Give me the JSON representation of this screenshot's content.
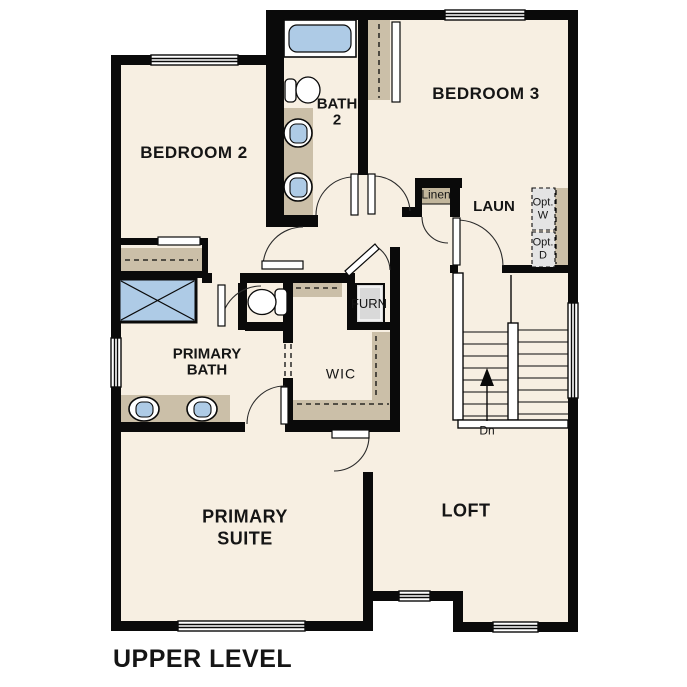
{
  "title": "UPPER LEVEL",
  "rooms": {
    "bedroom2": "BEDROOM 2",
    "bedroom3": "BEDROOM 3",
    "bath2": [
      "BATH",
      "2"
    ],
    "laundry": "LAUN",
    "loft": "LOFT",
    "primary_bath": [
      "PRIMARY",
      "BATH"
    ],
    "primary_suite": [
      "PRIMARY",
      "SUITE"
    ],
    "wic": "WIC"
  },
  "closets": {
    "linen": "Linen",
    "furnace": "FURN"
  },
  "appliances": {
    "optional_washer": [
      "Opt.",
      "W"
    ],
    "optional_dryer": [
      "Opt.",
      "D"
    ]
  },
  "stairs": {
    "direction_label": "Dn"
  },
  "colors": {
    "floor": "#f7efe2",
    "wall": "#0a0a0a",
    "cabinet_tan": "#cbbfa8",
    "shelf_tan": "#c2b69c",
    "fixture_blue": "#aecbe6",
    "appliance_gray": "#d9d9d9",
    "optional_gray": "#e4e4e4",
    "outside": "#ffffff"
  }
}
